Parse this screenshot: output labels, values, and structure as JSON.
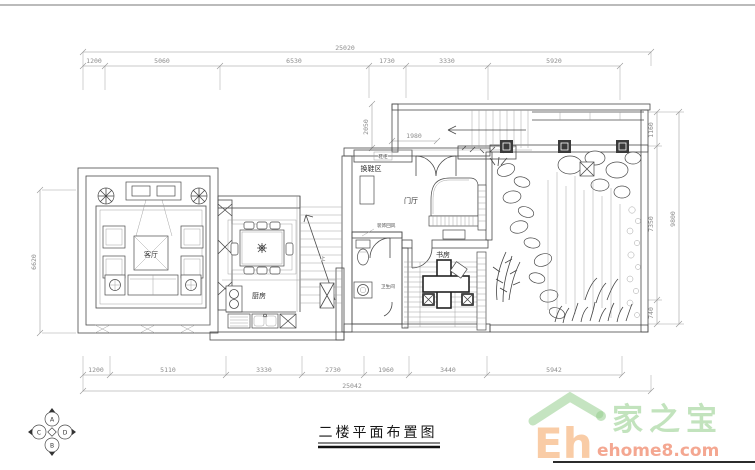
{
  "title": {
    "label": "二楼平面布置图"
  },
  "dimensions": {
    "top": {
      "overall": "25020",
      "segments": [
        "1200",
        "5060",
        "6530",
        "1730",
        "3330",
        "5920"
      ]
    },
    "bottom": {
      "overall": "25042",
      "segments": [
        "1200",
        "5110",
        "3330",
        "2730",
        "1960",
        "3440",
        "5942"
      ]
    },
    "left": {
      "overall": "6620"
    },
    "right": {
      "overall": "9800",
      "segments": [
        "1160",
        "7350",
        "740"
      ]
    },
    "stair": {
      "height": "2050",
      "width": "1980"
    }
  },
  "rooms": {
    "living": "客厅",
    "kitchen": "厨房",
    "foyer": "门厅",
    "study": "书房",
    "shoe_area": "换鞋区",
    "bathroom": "卫生间",
    "shoe_cabinet": "鞋柜",
    "screen_note": "装饰回风",
    "stair_up": "上"
  },
  "compass": {
    "a": "A",
    "b": "B",
    "c": "C",
    "d": "D"
  },
  "logo": {
    "eh": "Eh",
    "brand": "家之宝",
    "domain": "ehome8.com"
  },
  "colors": {
    "line": "#4a4a4a",
    "dim_text": "#8d8d8d",
    "logo_green": "#96ce8e",
    "logo_orange": "#f5ac70",
    "logo_red": "#ee7a58"
  }
}
